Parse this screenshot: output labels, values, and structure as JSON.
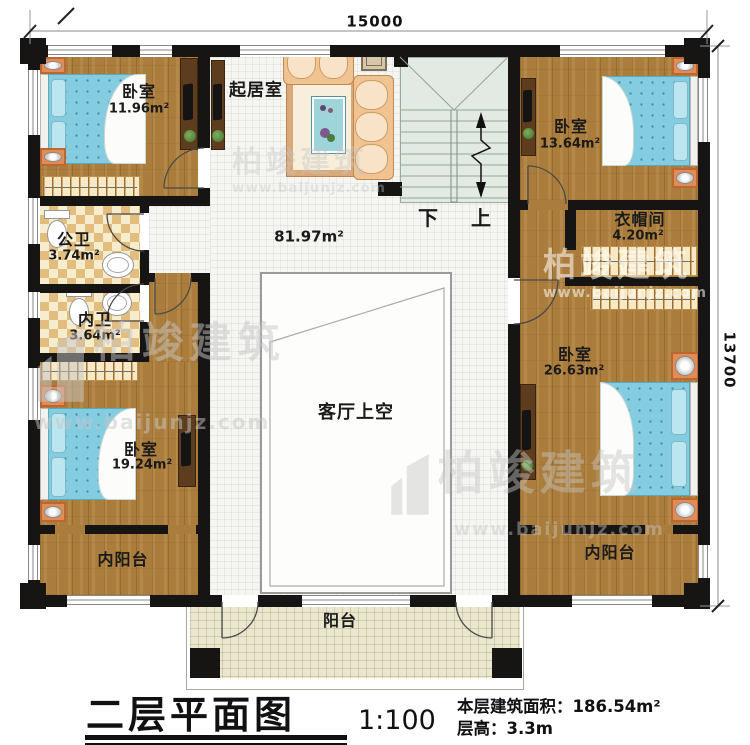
{
  "dimensions": {
    "top": "15000",
    "right": "13700"
  },
  "rooms": {
    "bedroom_top_left": {
      "name": "卧室",
      "area": "11.96m²"
    },
    "living_room": {
      "name": "起居室"
    },
    "hall_area_label": "81.97m²",
    "bedroom_top_right": {
      "name": "卧室",
      "area": "13.64m²"
    },
    "cloakroom": {
      "name": "衣帽间",
      "area": "4.20m²"
    },
    "bedroom_right": {
      "name": "卧室",
      "area": "26.63m²"
    },
    "public_bath": {
      "name": "公卫",
      "area": "3.74m²"
    },
    "inner_bath": {
      "name": "内卫",
      "area": "3.64m²"
    },
    "bedroom_bottom_left": {
      "name": "卧室",
      "area": "19.24m²"
    },
    "inner_balcony_left": {
      "name": "内阳台"
    },
    "inner_balcony_right": {
      "name": "内阳台"
    },
    "void_space": {
      "name": "客厅上空"
    },
    "balcony": {
      "name": "阳台"
    }
  },
  "stairs": {
    "down": "下",
    "up": "上"
  },
  "title_block": {
    "title": "二层平面图",
    "scale": "1:100",
    "floor_area": "本层建筑面积：186.54m²",
    "floor_height": "层高：3.3m"
  },
  "watermark": {
    "brand": "柏竣建筑",
    "url": "www.baijunjz.com"
  },
  "colors": {
    "wall": "#171513",
    "wood": "#ab7d3d",
    "tile": "#f5f5f2",
    "bath": "#e2bd7e",
    "stair": "#e3eae3",
    "balcony": "#ebe7cf",
    "bed": "#84cde0"
  }
}
